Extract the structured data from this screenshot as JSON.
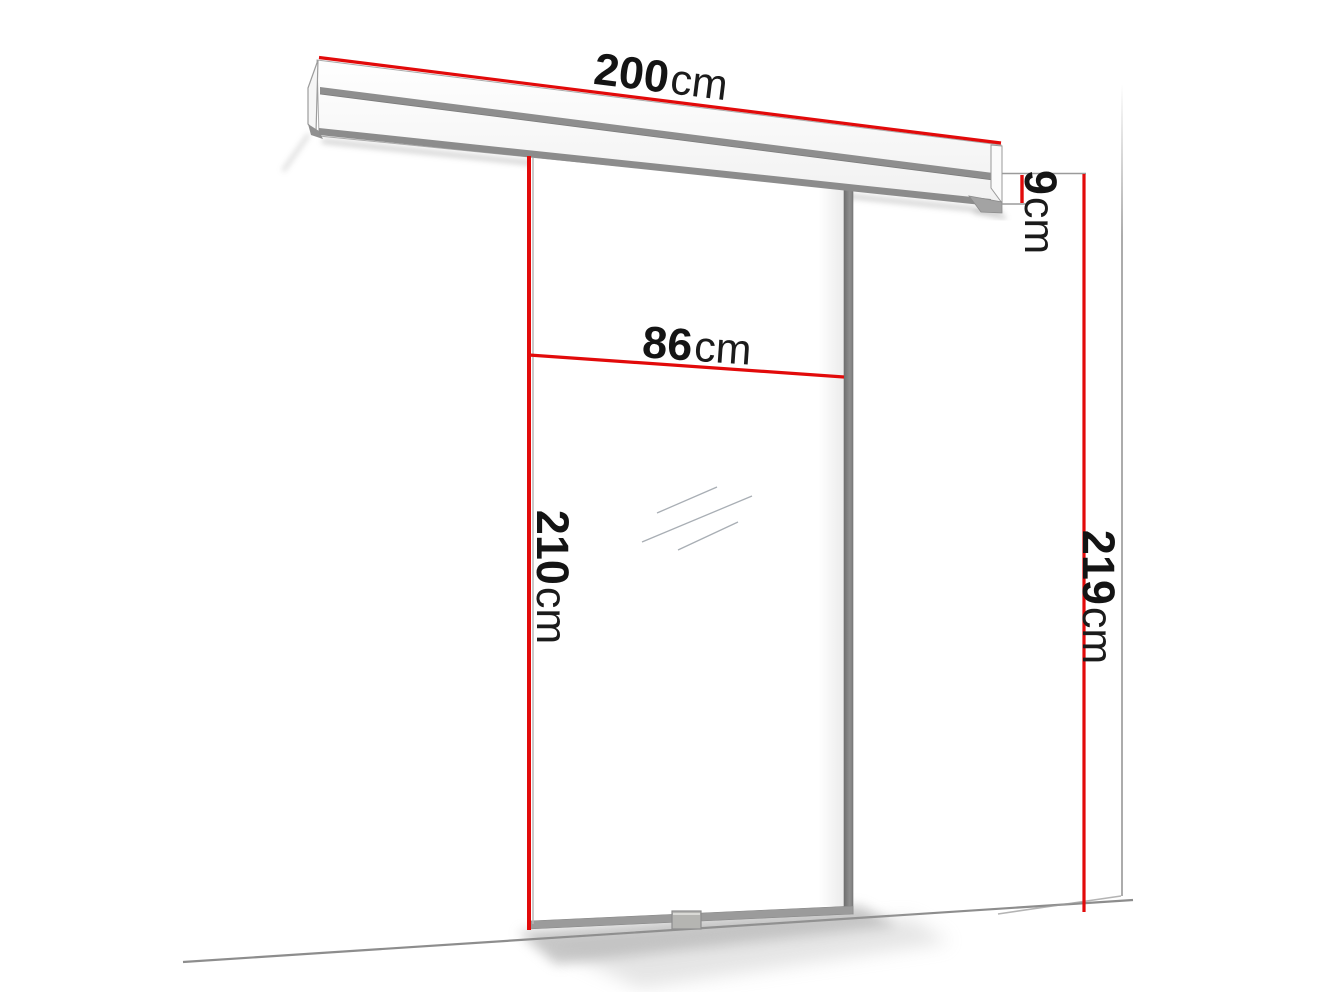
{
  "diagram": {
    "kind": "sliding-door-dimension-diagram",
    "accent_color": "#e20a0a",
    "metal_color": "#8d8d8d",
    "labels": {
      "track_width": {
        "value": "200",
        "unit": "cm"
      },
      "track_height": {
        "value": "9",
        "unit": "cm"
      },
      "door_width": {
        "value": "86",
        "unit": "cm"
      },
      "door_height": {
        "value": "210",
        "unit": "cm"
      },
      "total_height": {
        "value": "219",
        "unit": "cm"
      }
    }
  }
}
